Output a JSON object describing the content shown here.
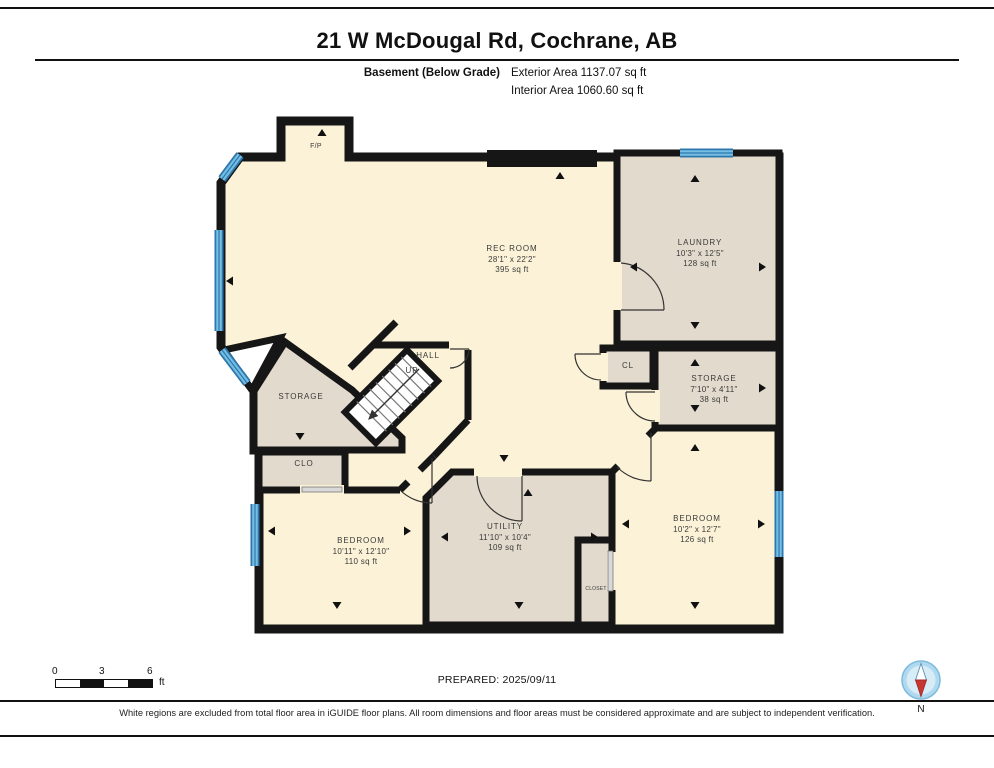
{
  "page": {
    "title": "21 W McDougal Rd, Cochrane, AB",
    "floor_label": "Basement (Below Grade)",
    "exterior_area": "Exterior Area 1137.07 sq ft",
    "interior_area": "Interior Area 1060.60 sq ft",
    "prepared": "PREPARED: 2025/09/11",
    "disclaimer": "White regions are excluded from total floor area in iGUIDE floor plans. All room dimensions and floor areas must be considered approximate and are subject to independent verification.",
    "compass_label": "N"
  },
  "scale_bar": {
    "start": "0",
    "mid": "3",
    "end": "6",
    "unit": "ft"
  },
  "rooms": [
    {
      "name": "REC ROOM",
      "dims": "28'1\" x 22'2\"",
      "area": "395 sq ft"
    },
    {
      "name": "LAUNDRY",
      "dims": "10'3\" x 12'5\"",
      "area": "128 sq ft"
    },
    {
      "name": "STORAGE",
      "dims": "7'10\" x 4'11\"",
      "area": "38 sq ft"
    },
    {
      "name": "BEDROOM",
      "dims": "10'2\" x 12'7\"",
      "area": "126 sq ft"
    },
    {
      "name": "UTILITY",
      "dims": "11'10\" x 10'4\"",
      "area": "109 sq ft"
    },
    {
      "name": "BEDROOM",
      "dims": "10'11\" x 12'10\"",
      "area": "110 sq ft"
    },
    {
      "name": "STORAGE"
    },
    {
      "name": "HALL"
    },
    {
      "name": "UP"
    },
    {
      "name": "CLO"
    },
    {
      "name": "CL"
    },
    {
      "name": "CLOSET"
    },
    {
      "name": "F/P"
    }
  ],
  "colors": {
    "wall": "#161616",
    "room_included": "#FBF2D7",
    "room_excluded": "#E2DACC",
    "window_light": "#74BEE4",
    "window_dark": "#2E77AC",
    "compass_red": "#C63633"
  }
}
